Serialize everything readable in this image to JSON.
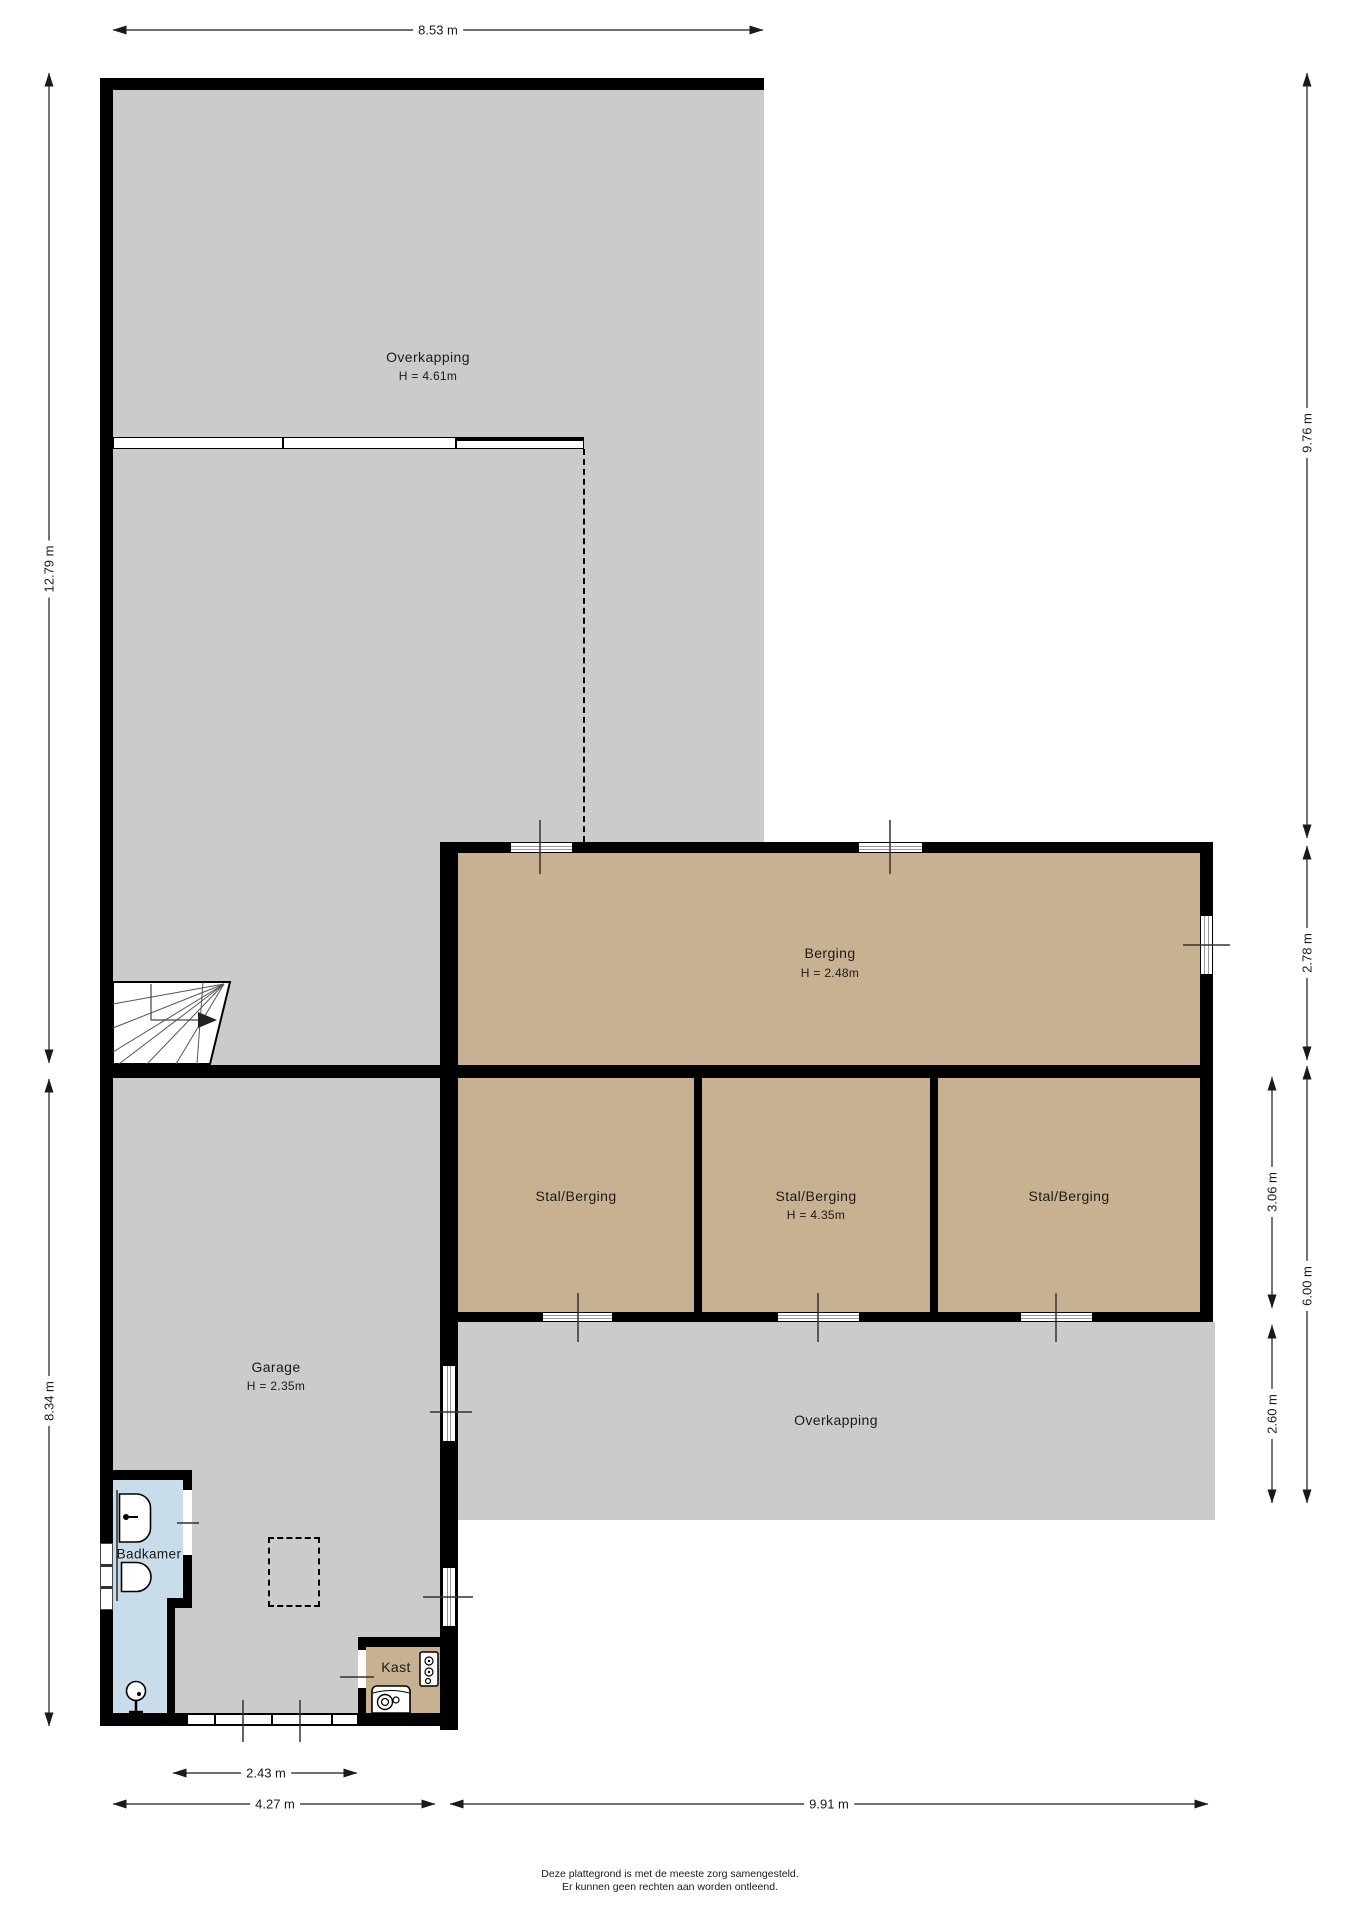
{
  "plan": {
    "rooms": {
      "overkapping_top": {
        "label": "Overkapping",
        "height_label": "H = 4.61m"
      },
      "berging": {
        "label": "Berging",
        "height_label": "H = 2.48m"
      },
      "stal_berging_1": {
        "label": "Stal/Berging"
      },
      "stal_berging_2": {
        "label": "Stal/Berging",
        "height_label": "H = 4.35m"
      },
      "stal_berging_3": {
        "label": "Stal/Berging"
      },
      "garage": {
        "label": "Garage",
        "height_label": "H = 2.35m"
      },
      "overkapping_bottom": {
        "label": "Overkapping"
      },
      "badkamer": {
        "label": "Badkamer"
      },
      "kast": {
        "label": "Kast"
      }
    },
    "dimensions": {
      "top_width": "8.53 m",
      "left_upper_height": "12.79 m",
      "left_lower_height": "8.34 m",
      "right_upper_height": "9.76 m",
      "right_berging_height": "2.78 m",
      "right_stal_height": "3.06 m",
      "right_lower_total_height": "6.00 m",
      "right_overkapping_height": "2.60 m",
      "bottom_garage_door_width": "2.43 m",
      "bottom_garage_width": "4.27 m",
      "bottom_right_width": "9.91 m"
    },
    "colors": {
      "wall": "#000000",
      "floor_covered": "#cbcbcb",
      "floor_storage": "#c8b190",
      "floor_bathroom": "#c9dcea"
    }
  },
  "footer": {
    "line1": "Deze plattegrond is met de meeste zorg samengesteld.",
    "line2": "Er kunnen geen rechten aan worden ontleend."
  }
}
